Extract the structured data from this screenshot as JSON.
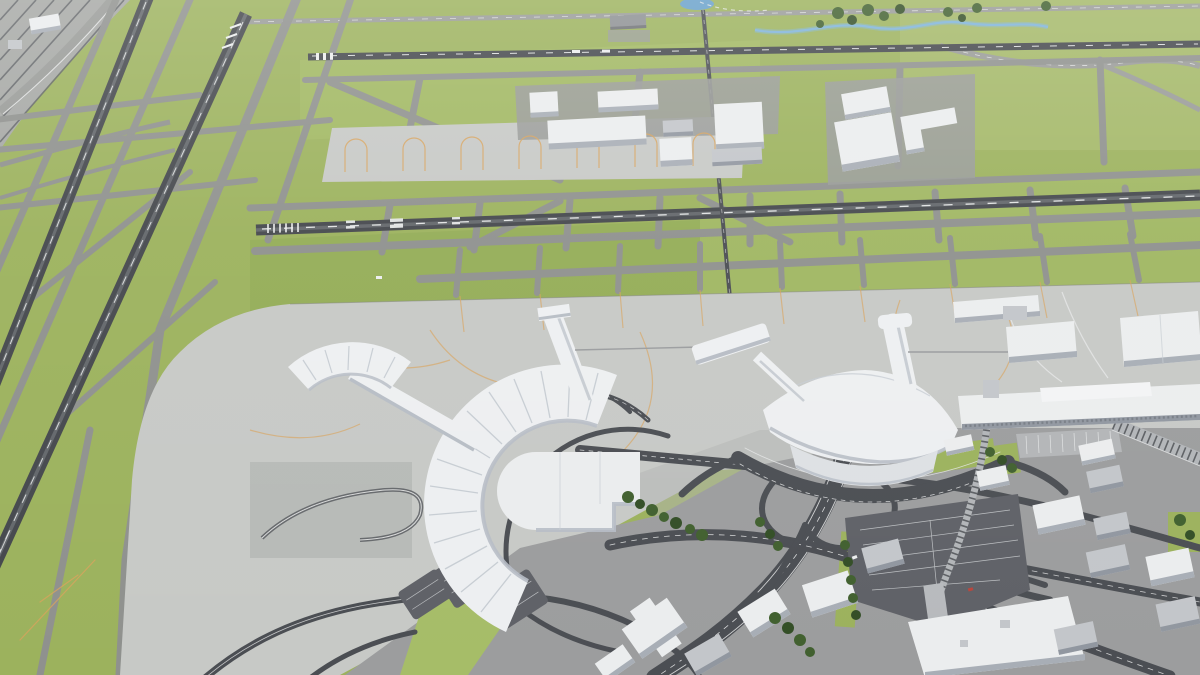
{
  "scene": {
    "type": "3d-aerial-render",
    "subject": "airport-3d-model",
    "view": "oblique high-angle aerial view of an airport with two terminals, runways, taxiway network, cargo aprons, highway interchange and surrounding city blocks",
    "text_content": "none"
  },
  "palette": {
    "grass": "#9cb25d",
    "grassBright": "#a6bd68",
    "grassDark": "#8aa450",
    "grassPale": "#b4c47e",
    "taxiway": "#8f918e",
    "taxiwayDark": "#7e807d",
    "runway": "#45484d",
    "runwayWorn": "#63676b",
    "marking": "#eceeee",
    "apron": "#c7c9c6",
    "apronShade": "#b2b4b1",
    "tarmac": "#999b98",
    "urban": "#9c9d9e",
    "road": "#4b4e53",
    "roadMid": "#6a6d71",
    "roadLine": "#e6e7e7",
    "parking": "#5f6167",
    "parkingLine": "#cdd0d2",
    "parkingLight": "#b3b5b7",
    "building": "#ebedee",
    "buildingShade": "#a8aeb6",
    "buildingGray": "#c3c6ca",
    "buildingGrayShade": "#9197a0",
    "terminal": "#edeff1",
    "terminalShade": "#b7bdc5",
    "rib": "#c7cdd3",
    "guideline": "#d8a35d",
    "water": "#68a0ca",
    "stream": "#7fb3d9",
    "tree": "#41602f",
    "treeDark": "#334e26",
    "railYard": "#a6a8a5",
    "railBand": "#b2b5b8",
    "tie": "#5d6064"
  },
  "landmarks": {
    "west_terminal": "y-shaped-terminal-with-curved-ribbed-concourse",
    "east_terminal": "curved-terminal-with-two-piers",
    "runways": "two-diagonal-left-runways-and-two-horizontal-runways",
    "cargo_area": "cargo-apron-with-warehouses-north",
    "landside": "highway-interchange-parking-lots-city-blocks",
    "transit": "people-mover-track-to-landside-station",
    "rail_yard": "rail-yard-top-left-corner",
    "water": "pond-and-stream-along-north-edge"
  }
}
